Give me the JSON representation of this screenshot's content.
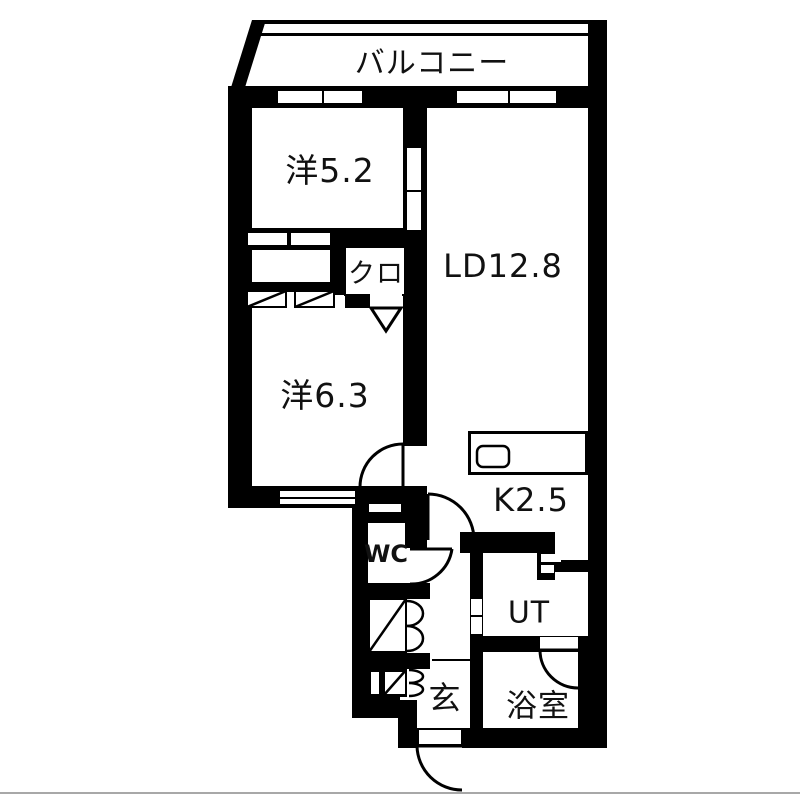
{
  "floor_plan": {
    "title": "apartment-floor-plan-2LDK",
    "rooms": [
      {
        "id": "balcony",
        "label": "バルコニー"
      },
      {
        "id": "bedroom1",
        "label": "洋5.2"
      },
      {
        "id": "closet",
        "label": "クロ"
      },
      {
        "id": "living_dining",
        "label": "LD12.8"
      },
      {
        "id": "bedroom2",
        "label": "洋6.3"
      },
      {
        "id": "kitchen",
        "label": "K2.5"
      },
      {
        "id": "wc",
        "label": "WC"
      },
      {
        "id": "utility",
        "label": "UT"
      },
      {
        "id": "entrance",
        "label": "玄"
      },
      {
        "id": "bathroom",
        "label": "浴室"
      }
    ],
    "colors": {
      "wall": "#000000",
      "floor": "#ffffff",
      "text": "#111111"
    }
  }
}
